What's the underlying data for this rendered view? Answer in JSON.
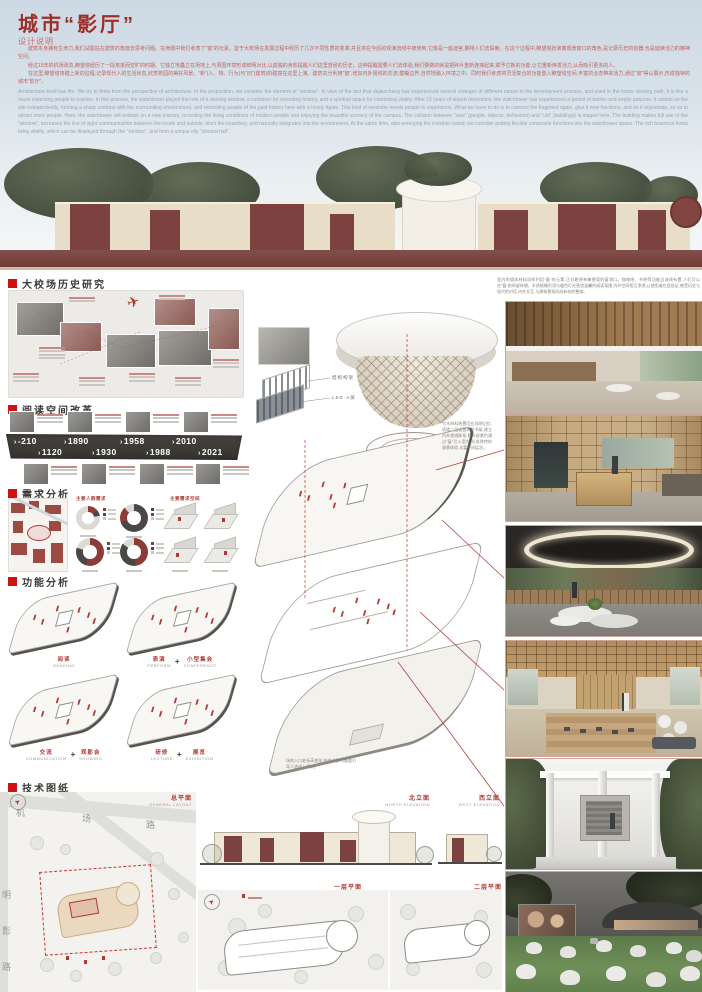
{
  "board": {
    "title": "城市“影厅”",
    "subtitle": "设计说明"
  },
  "intro": {
    "p1": "建筑本身拥有生命力,我们试图站在建筑的角度去思考问题。在命题中我们考虑了“窗”的元素。鉴于大校场在发展过程中经历了几次不同性质的变革,并且将在今后的观演流线中被使用,它像是一座迷宫,期待人们去探索。在这个过程中,瞭望塔扮演着观景窗口的角色,是记录历史的容器,也是延续活力的精神空间。",
    "p2": "经过15年的机场改造,瞭望塔经历了一段荒芜而空旷的时期。它独立地矗立在场地上,与周围环境形成鲜明对比,以孤独的身影提醒人们这里曾经的历史。这种提醒需要人们去体验,我们要做的就是把碎片重新连接起来,赋予它新的功能,让它重新焕发活力,从而吸引更多的人。",
    "p3": "在这里,瞭望塔将踏上新的征程,记录现代人的生活状态,欣赏校园的美好风景。“新”(人、物、行为)与“旧”(建筑)的碰撞在这里上演。建筑充分利用“窗”,增加内外视线的交流,模糊边界,自然地融入环境之中。同时我们考虑将灵活复合的功能置入瞭望塔空间,丰富的业态带来活力,通过“窗”得以展示,形成独特的城市“影厅”。",
    "english": "Architecture itself has life. We try to think from the perspective of architecture. In the proposition, we consider the element of “window”. In view of the fact that dajiaochang has experienced several changes of different nature in the development process, and used in the future viewing path, it is like a maze expecting people to explore. In this process, the watchtower played the role of a viewing window, a container for recording history, and a spiritual space for continuing vitality. After 15 years of airport renovation, the watchtower has experienced a period of barren and empty purpose. It stands on the site independently, forming a sharp contrast with the surrounding environment, and reminding people of the past history here with a lonely figure. This kind of reminder needs people to experience. What we have to do is to connect the fragment again, give it new functions, and let it rejuvenate, so as to attract more people. Here, the watchtower will embark on a new journey, recording the living conditions of modern people and enjoying the beautiful scenery of the campus. The collision between “new” (people, objects, behaviors) and “old” (buildings) is staged here. The building makes full use of the “window”, increases the line of sight communication between the inside and outside, blurs the boundary, and naturally integrates into the environment. At the same time, also emerging the invisible crowd, we consider putting flexible composite functions into the watchtower space. The rich business forms bring vitality, which can be displayed through the “window”, and form a unique city “cinema hall”."
  },
  "right_note": "室内的墙体材料同样利用“窗”的元素,正对着原有瞭望塔的窗洞口。咖啡吧、书吧等功能沿流线布置,人们可以在“窗”前停留休憩。木质格栅吊顶与暖色灯光营造温馨的阅读氛围,内外空间相互渗透,让使用者在此驻足,感受历史与现代的对话,内外交互,与建筑景观形成有机的整体。",
  "sections": {
    "history": {
      "label": "大校场历史研究"
    },
    "reading": {
      "label": "阅读空间改革",
      "arrow": "›",
      "years_top": [
        "-210",
        "1890",
        "1958",
        "2010"
      ],
      "years_bottom": [
        "1120",
        "1930",
        "1988",
        "2021"
      ]
    },
    "demand": {
      "label": "需求分析",
      "group_left": "主要人群需求",
      "group_right": "主要需求空间",
      "donuts": [
        {
          "segments": [
            {
              "color": "#8e3a36",
              "value": 14
            },
            {
              "color": "#4a4846",
              "value": 8
            },
            {
              "color": "#dddad5",
              "value": 78
            }
          ]
        },
        {
          "segments": [
            {
              "color": "#4a4846",
              "value": 70
            },
            {
              "color": "#8e3a36",
              "value": 18
            },
            {
              "color": "#dddad5",
              "value": 12
            }
          ]
        },
        {
          "segments": [
            {
              "color": "#8e3a36",
              "value": 55
            },
            {
              "color": "#4a4846",
              "value": 25
            },
            {
              "color": "#dddad5",
              "value": 20
            }
          ]
        },
        {
          "segments": [
            {
              "color": "#8e3a36",
              "value": 48
            },
            {
              "color": "#4a4846",
              "value": 37
            },
            {
              "color": "#dddad5",
              "value": 15
            }
          ]
        }
      ]
    },
    "function": {
      "label": "功能分析",
      "plus": "+",
      "items": [
        {
          "cn": "阅读",
          "en": "READING"
        },
        {
          "cn": "表演",
          "en": "PERFORM",
          "cn2": "小型集会",
          "en2": "CONFERENCE"
        },
        {
          "cn": "交流",
          "en": "COMMUNICATION",
          "cn2": "观影会",
          "en2": "SHOWING"
        },
        {
          "cn": "研修",
          "en": "LECTURE",
          "cn2": "展览",
          "en2": "EXHIBITION"
        }
      ]
    },
    "tech": {
      "label": "技术图纸"
    }
  },
  "axon": {
    "structure_label": "结构构架",
    "led_label": "LED·A屏",
    "note1": "竹木材料装置回应场地记忆,塔楼二层设置环形书架,建立内外视线联系,将外部景色通过“窗”引入室内,形成独特的观景体验,丰富空间层次。",
    "note2": "场地入口处标高变化,结合台阶与坡道引导人流进入建筑。"
  },
  "drawings": {
    "site": {
      "cn": "总平面",
      "en": "GENERAL LAYOUT",
      "road_h": "机场路",
      "road_v": "明影路"
    },
    "north": {
      "cn": "北立面",
      "en": "NORTH ELEVATION"
    },
    "west": {
      "cn": "西立面",
      "en": "WEST ELEVATION"
    },
    "first": {
      "cn": "一层平面",
      "en": "FIRST FLOOR"
    },
    "second": {
      "cn": "二层平面",
      "en": "SECOND FLOOR"
    }
  }
}
